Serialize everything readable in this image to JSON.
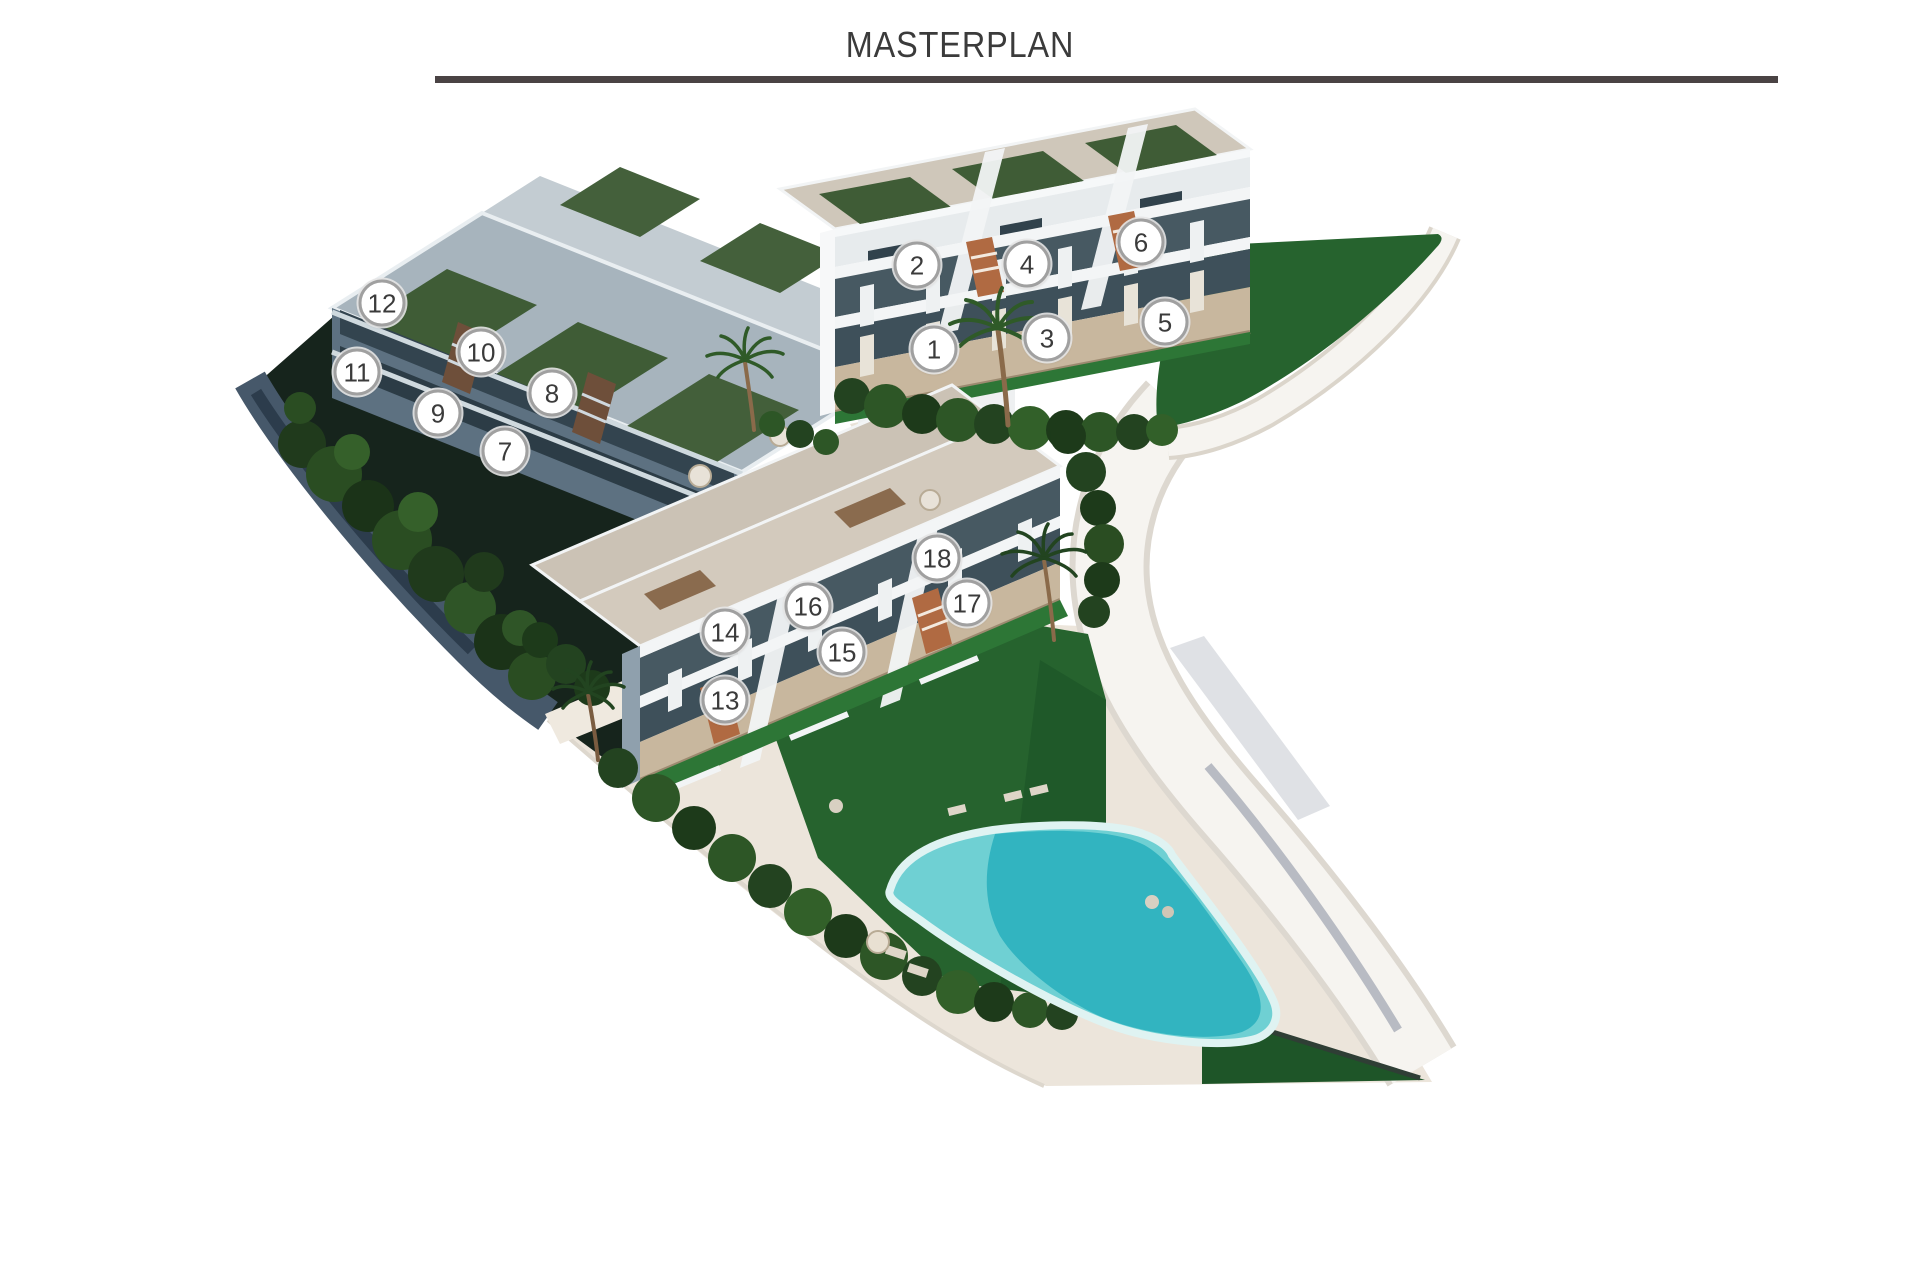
{
  "header": {
    "title": "MASTERPLAN"
  },
  "masterplan": {
    "units": [
      {
        "label": "1",
        "x": 934,
        "y": 349
      },
      {
        "label": "2",
        "x": 917,
        "y": 265
      },
      {
        "label": "3",
        "x": 1047,
        "y": 338
      },
      {
        "label": "4",
        "x": 1027,
        "y": 264
      },
      {
        "label": "5",
        "x": 1165,
        "y": 322
      },
      {
        "label": "6",
        "x": 1141,
        "y": 242
      },
      {
        "label": "7",
        "x": 505,
        "y": 451
      },
      {
        "label": "8",
        "x": 552,
        "y": 393
      },
      {
        "label": "9",
        "x": 438,
        "y": 413
      },
      {
        "label": "10",
        "x": 481,
        "y": 352
      },
      {
        "label": "11",
        "x": 357,
        "y": 372
      },
      {
        "label": "12",
        "x": 382,
        "y": 303
      },
      {
        "label": "13",
        "x": 725,
        "y": 700
      },
      {
        "label": "14",
        "x": 725,
        "y": 632
      },
      {
        "label": "15",
        "x": 842,
        "y": 652
      },
      {
        "label": "16",
        "x": 808,
        "y": 606
      },
      {
        "label": "17",
        "x": 967,
        "y": 603
      },
      {
        "label": "18",
        "x": 937,
        "y": 558
      }
    ]
  },
  "palette": {
    "title_text": "#3b3b3b",
    "rule": "#4a4344",
    "marker_ring": "#a0a0a0",
    "marker_text": "#3b3b3b",
    "pool_light": "#6fd0d3",
    "pool_deep": "#32b4c0",
    "pool_rim": "#dff3f2",
    "deck": "#ece5db",
    "road": "#f6f4f0",
    "lawn": "#26632e",
    "lawn_dark": "#1e5528",
    "lawn_strip": "#2d7636",
    "roof_lawn": "#3f5c36",
    "stone": "#c8b79e",
    "white_wall": "#f3f5f6",
    "shadow_wall": "#5d7181",
    "retaining_wall": "#46586a",
    "tree_dark": "#1d3a1a",
    "tree_mid": "#2d5626",
    "stair_terracotta": "#b06a42"
  }
}
